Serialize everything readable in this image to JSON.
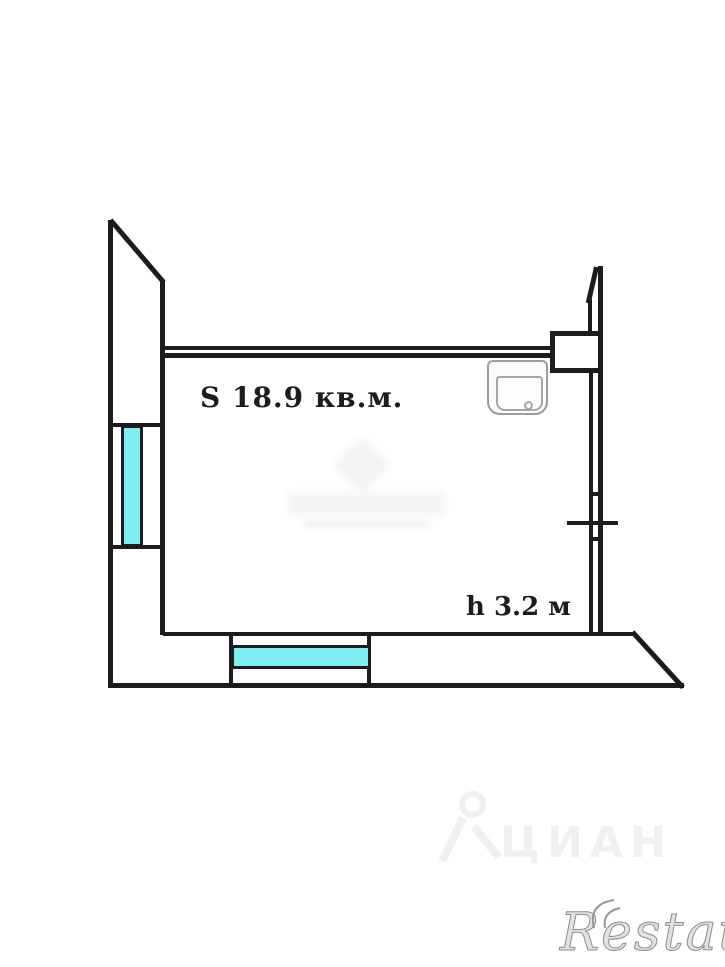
{
  "floor_plan": {
    "area_label": "S 18.9 кв.м.",
    "ceiling_height_label": "h 3.2 м",
    "colors": {
      "wall": "#1c1c1c",
      "window_glass": "#7deef2",
      "sink_outline": "#9b9b9b",
      "background": "#ffffff"
    },
    "features": {
      "windows": 2,
      "sink": "wall-mounted sink, top right",
      "shaft_box": "rectangular duct/shaft at top right"
    }
  },
  "watermarks": {
    "cian": {
      "text": "ЦИАН",
      "color": "#f0f0f0"
    },
    "restate": {
      "text": "Restate",
      "color": "#8f8f8a"
    }
  }
}
